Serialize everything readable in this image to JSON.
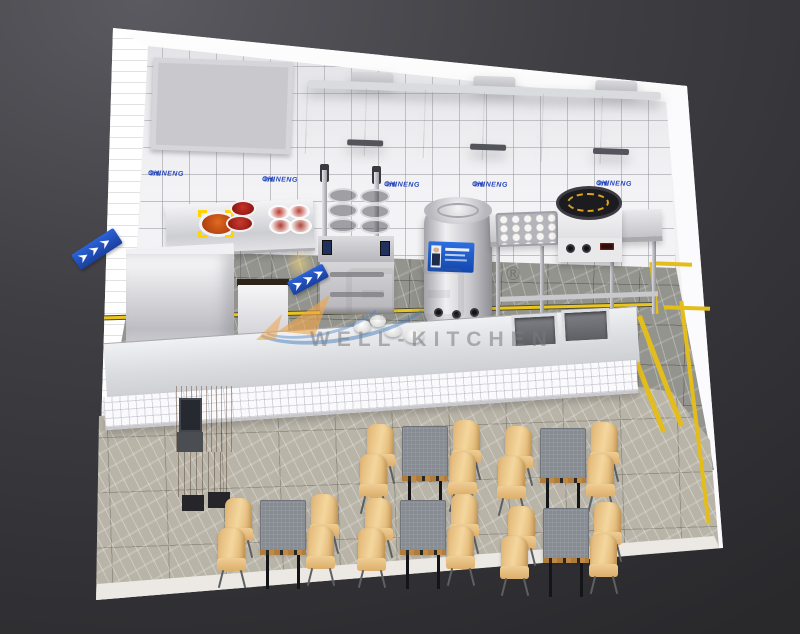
{
  "branding": {
    "wall_sign_text": "CHINENG",
    "wall_sign_suffix": "驰能",
    "sign_color": "#2747bd",
    "watermark_text": "WELL-KITCHEN",
    "registered_mark": "®"
  },
  "palette": {
    "background": "#3e3e43",
    "wall_tile": "#f3f3f5",
    "kitchen_floor_marble": "#93948d",
    "dining_floor_marble": "#b9b4a8",
    "safety_line_yellow": "#eac51d",
    "stainless_steel": "#d6d7da",
    "soup_kettle_label_blue": "#1a52c4",
    "chair_wood": "#e8c083",
    "table_top_grey": "#878c93",
    "cashier_wood": "#8a5a2c"
  },
  "counts": {
    "dining_tables": 5,
    "chairs_per_table": 4,
    "wall_signs": 5,
    "window_panes": 3,
    "hood_sections": 3,
    "sink_basins": 2
  }
}
